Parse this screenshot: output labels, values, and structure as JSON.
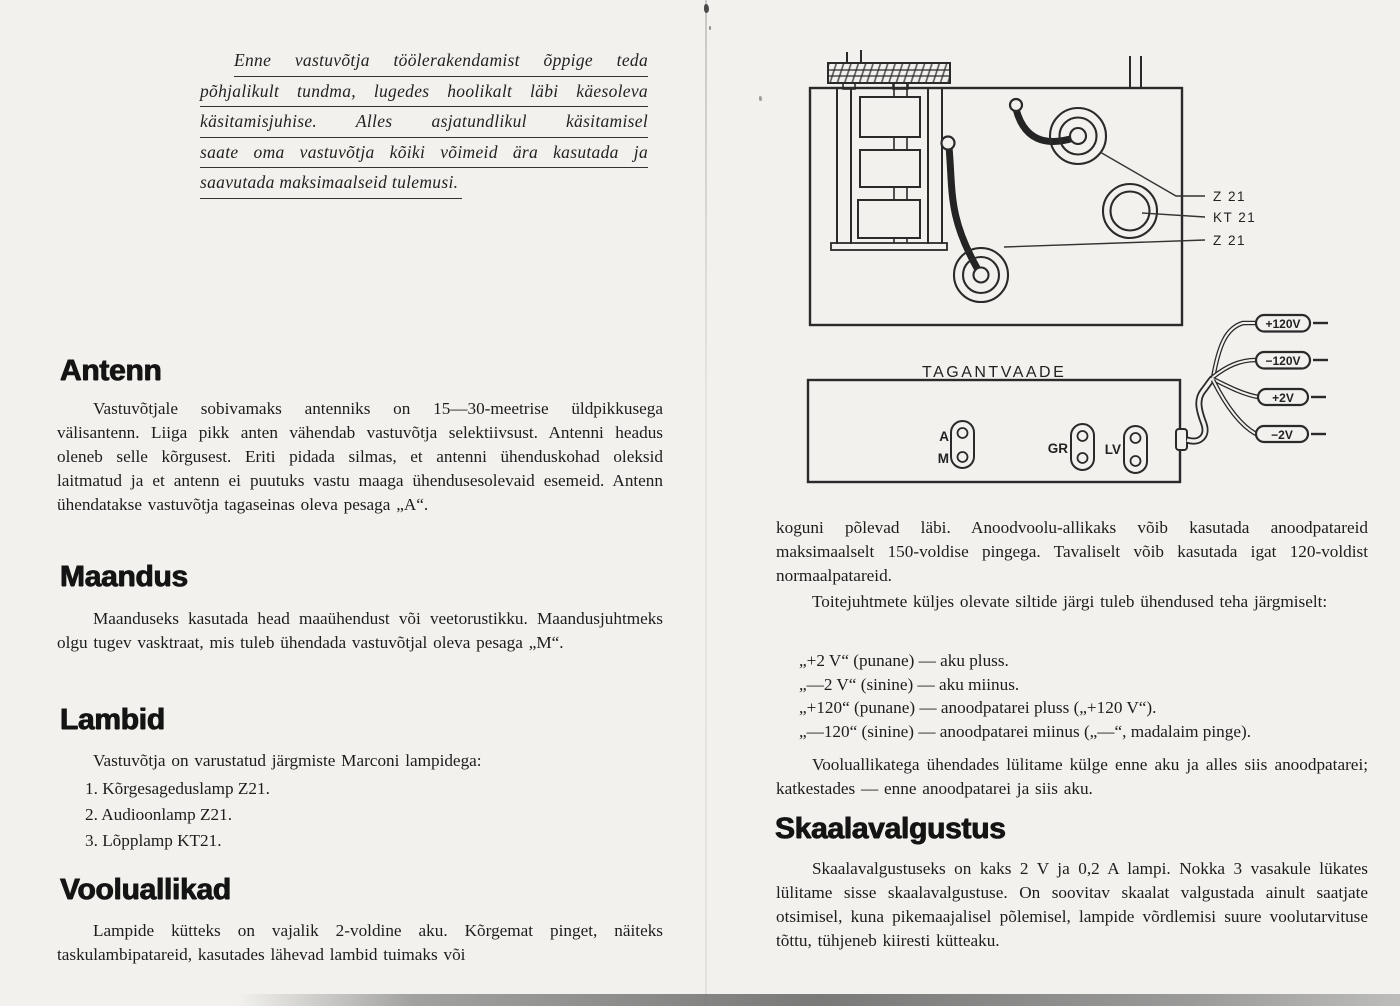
{
  "intro": {
    "lines": [
      "Enne vastuvõtja töölerakendamist õppige teda",
      "põhjalikult tundma, lugedes hoolikalt läbi käesoleva",
      "käsitamisjuhise.  Alles  asjatundlikul  käsitamisel",
      "saate oma vastuvõtja kõiki võimeid ära kasutada ja",
      "saavutada maksimaalseid tulemusi."
    ]
  },
  "sections": {
    "antenn": {
      "heading": "Antenn",
      "body": "Vastuvõtjale sobivamaks antenniks on 15—30-meetrise üldpikkusega välisantenn. Liiga pikk anten vähendab vastuvõtja selektiivsust. Antenni headus oleneb selle kõrgusest. Eriti pidada silmas, et antenni ühenduskohad oleksid laitmatud ja et antenn ei puutuks vastu maaga ühendusesolevaid esemeid. Antenn ühendatakse vastuvõtja tagaseinas oleva pesaga „A“."
    },
    "maandus": {
      "heading": "Maandus",
      "body": "Maanduseks kasutada head maaühendust või veetorustikku. Maandusjuhtmeks olgu tugev vasktraat, mis tuleb ühendada vastuvõtjal oleva pesaga „M“."
    },
    "lambid": {
      "heading": "Lambid",
      "lead": "Vastuvõtja on varustatud järgmiste Marconi lampidega:",
      "items": [
        "1.  Kõrgesageduslamp Z21.",
        "2.  Audioonlamp Z21.",
        "3.  Lõpplamp KT21."
      ]
    },
    "vooluallikad": {
      "heading": "Vooluallikad",
      "body": "Lampide kütteks on vajalik 2-voldine aku. Kõrgemat pinget, näiteks taskulambipatareid, kasutades lähevad lambid tuimaks või"
    }
  },
  "right_column": {
    "para_continued": "koguni põlevad läbi. Anoodvoolu-allikaks võib kasutada anoodpatareid maksimaalselt 150-voldise pingega. Tavaliselt võib kasutada igat 120-voldist normaalpatareid.",
    "para_instructions": "Toitejuhtmete küljes olevate siltide järgi tuleb ühendused teha järgmiselt:",
    "connections": [
      "„+2 V“  (punane)  —  aku  pluss.",
      "„—2 V“  (sinine)  —  aku  miinus.",
      "„+120“  (punane)  —  anoodpatarei  pluss  („+120 V“).",
      "„—120“  (sinine)  —  anoodpatarei miinus („—“, madalaim pinge)."
    ],
    "para_order": "Vooluallikatega ühendades lülitame külge enne aku ja alles siis anoodpatarei; katkestades — enne anoodpatarei ja siis aku.",
    "skaala_heading": "Skaalavalgustus",
    "skaala_body": "Skaalavalgustuseks on kaks 2 V ja 0,2 A lampi. Nokka 3 vasakule lükates lülitame sisse skaalavalgustuse. On soovitav skaalat valgustada ainult saatjate otsimisel, kuna pikemaajalisel põlemisel, lampide võrdlemisi suure voolutarvituse tõttu, tühjeneb kiiresti kütteaku."
  },
  "diagram": {
    "back_view_label": "TAGANTVAADE",
    "tube_labels": [
      "Z 21",
      "KT 21",
      "Z 21"
    ],
    "socket_labels": [
      "A",
      "M",
      "GR",
      "LV"
    ],
    "cable_tags": [
      "+120V",
      "−120V",
      "+2V",
      "−2V"
    ],
    "ink_color": "#2a2a2a"
  }
}
